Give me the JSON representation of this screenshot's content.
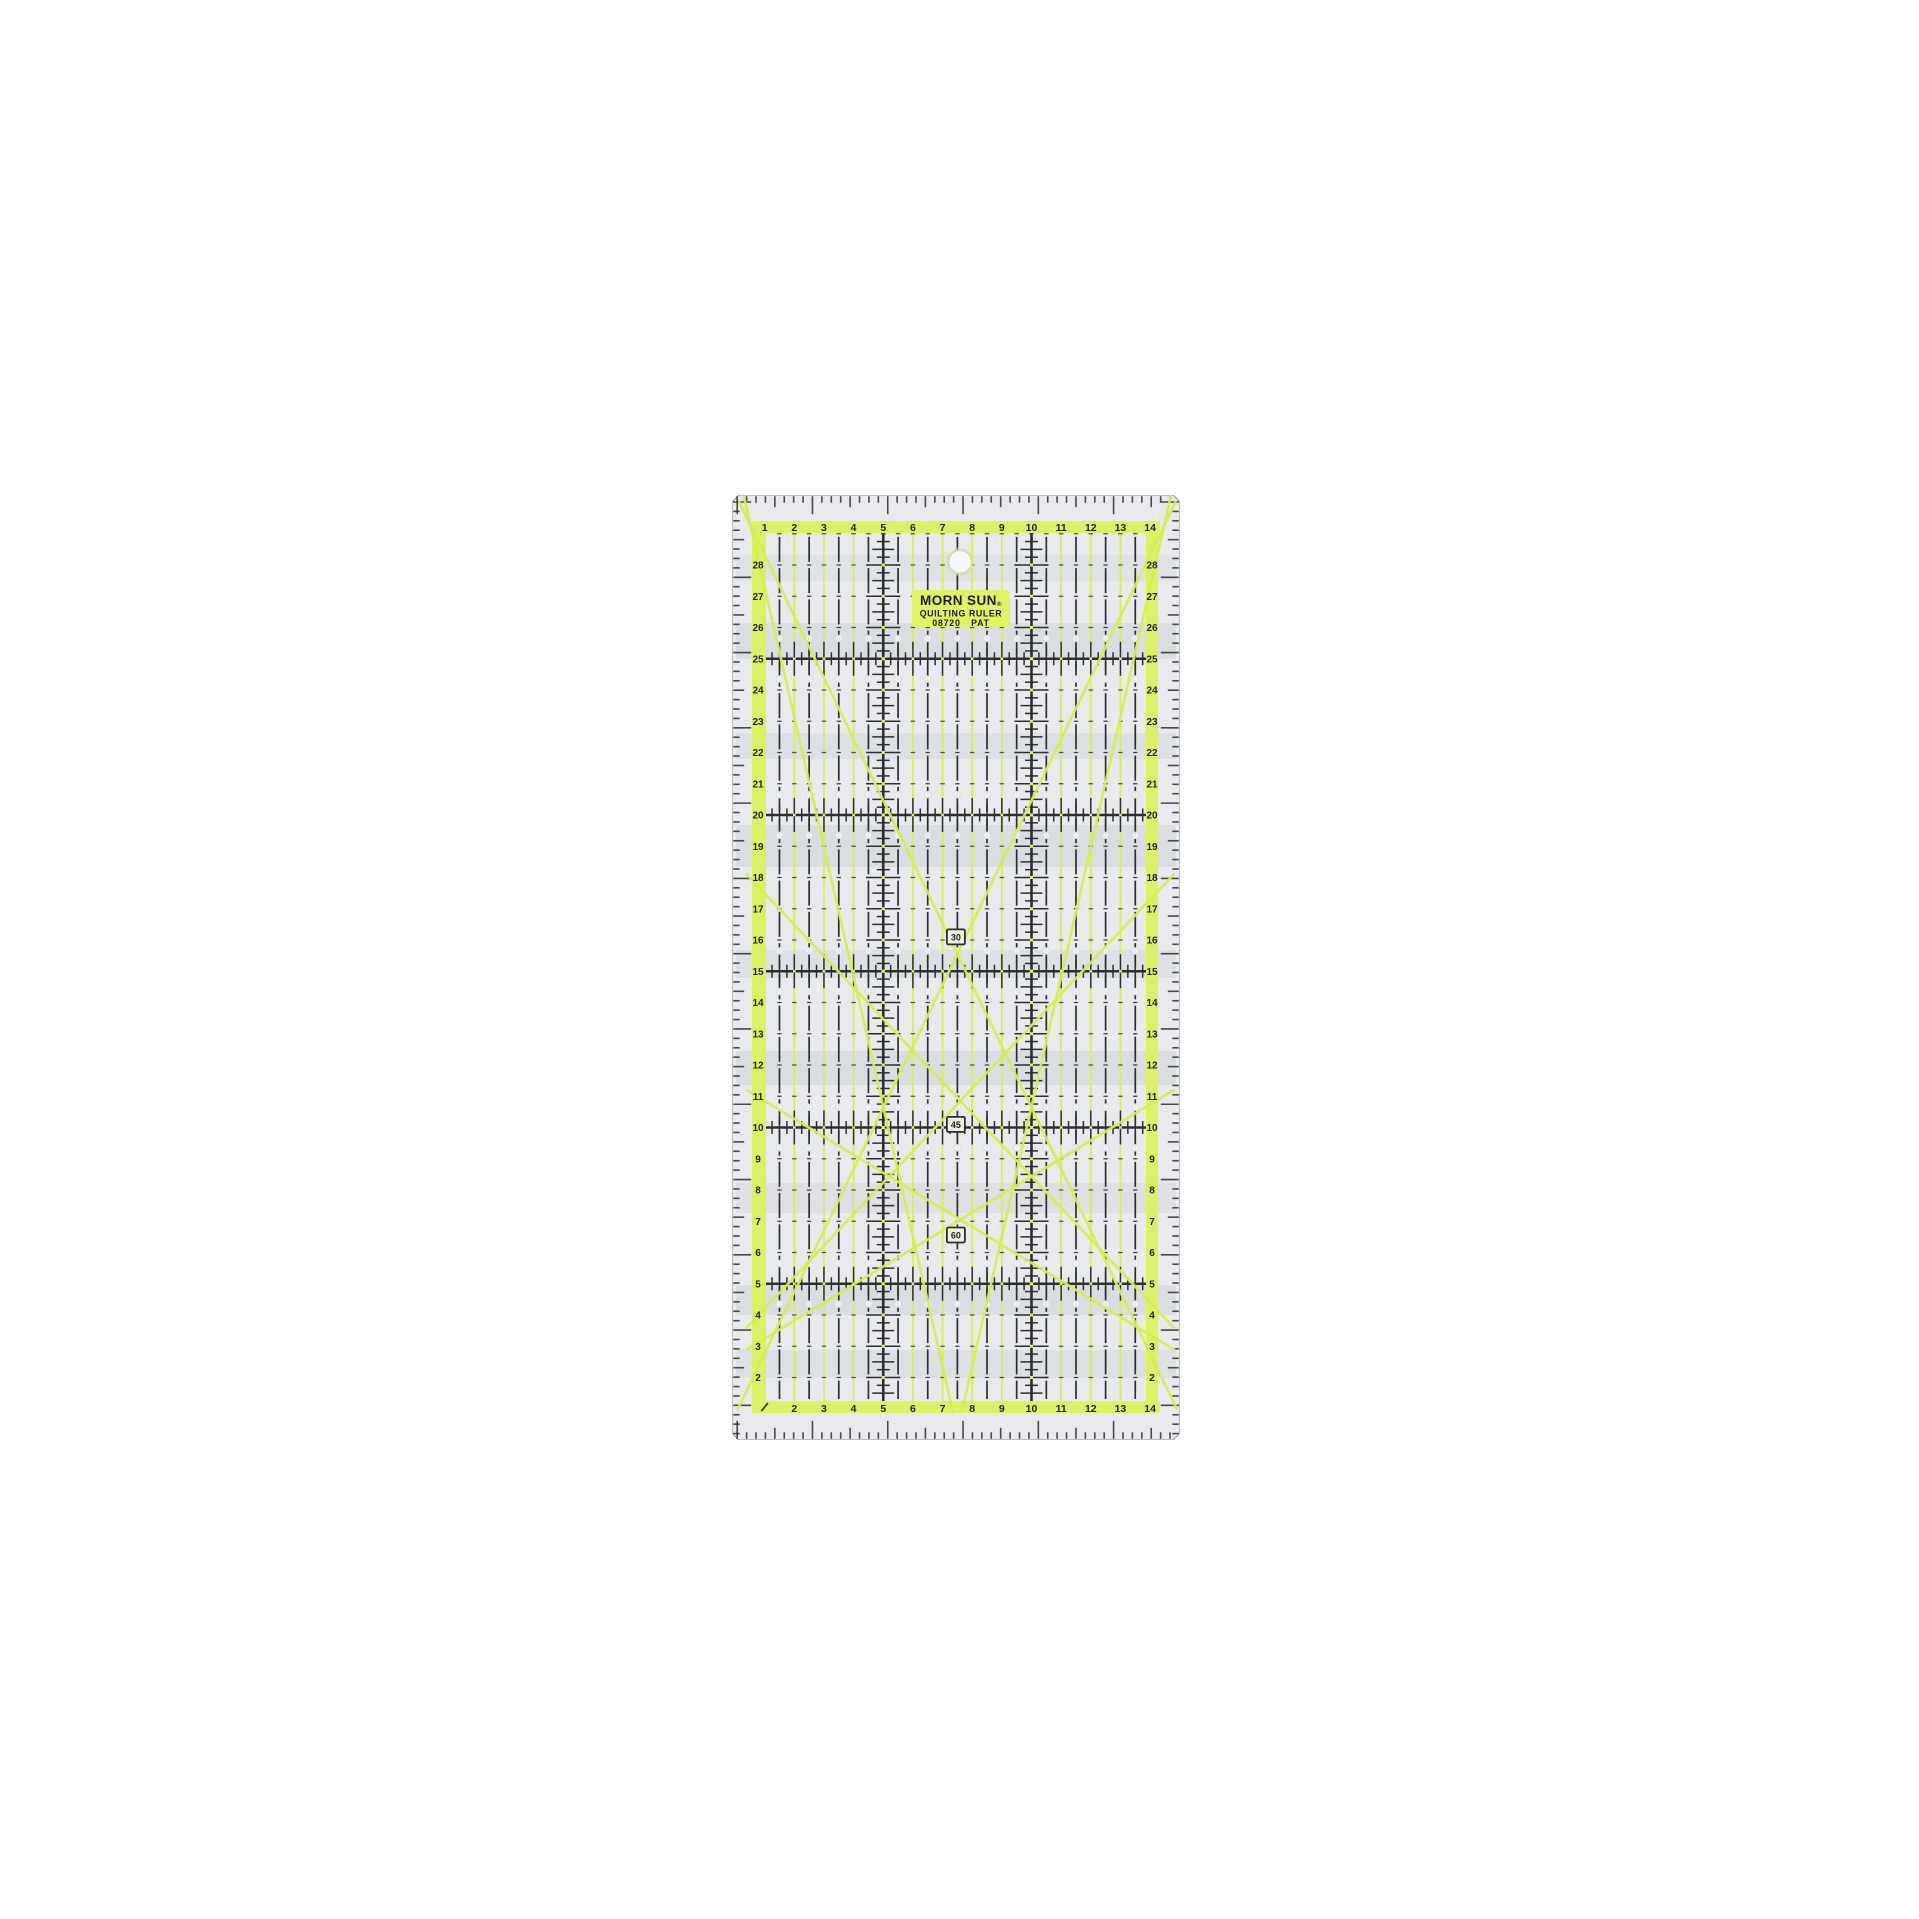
{
  "background_color": "#ffffff",
  "ruler": {
    "brand_label": {
      "line1": "MORN SUN",
      "registered": "®",
      "line2": "QUILTING RULER",
      "model": "08720",
      "pat": "PAT"
    },
    "angle_labels": [
      {
        "value": "30",
        "x_cm": 7.45,
        "y_cm": 16.1
      },
      {
        "value": "45",
        "x_cm": 7.45,
        "y_cm": 10.1
      },
      {
        "value": "60",
        "x_cm": 7.45,
        "y_cm": 6.56
      }
    ],
    "scales": {
      "top_numbers": [
        1,
        2,
        3,
        4,
        5,
        6,
        7,
        8,
        9,
        10,
        11,
        12,
        13,
        14
      ],
      "bottom_numbers": [
        2,
        3,
        4,
        5,
        6,
        7,
        8,
        9,
        10,
        11,
        12,
        13,
        14
      ],
      "left_numbers": [
        2,
        3,
        4,
        5,
        6,
        7,
        8,
        9,
        10,
        11,
        12,
        13,
        14,
        15,
        16,
        17,
        18,
        19,
        20,
        21,
        22,
        23,
        24,
        25,
        26,
        27,
        28
      ],
      "right_numbers": [
        2,
        3,
        4,
        5,
        6,
        7,
        8,
        9,
        10,
        11,
        12,
        13,
        14,
        15,
        16,
        17,
        18,
        19,
        20,
        21,
        22,
        23,
        24,
        25,
        26,
        27,
        28
      ]
    },
    "grid": {
      "width_cm": 15,
      "height_cm": 30,
      "major_lines_cm": [
        5,
        10,
        15,
        20,
        25
      ],
      "major_vertical_cm": [
        5,
        10
      ],
      "yellow_vertical_cm": [
        1,
        2,
        3,
        4,
        5,
        6,
        7,
        8,
        9,
        10,
        11,
        12,
        13
      ],
      "dashed_vertical_cm": [
        1.5,
        2.5,
        3.5,
        4.5,
        5.5,
        6.5,
        7.5,
        8.5,
        9.5,
        10.5,
        11.5,
        12.5,
        13.5
      ],
      "minor_row_cm": [
        2,
        3,
        4,
        6,
        7,
        8,
        9,
        11,
        12,
        13,
        14,
        16,
        17,
        18,
        19,
        21,
        22,
        23,
        24,
        26,
        27,
        28,
        29
      ],
      "dot_rows_cm": [
        4.35,
        5.65,
        9.35,
        10.65,
        14.35,
        15.65,
        19.35,
        20.65,
        24.35,
        25.65
      ],
      "dot_cols_cm": [
        1.5,
        2.5,
        3.5,
        4.5,
        5.5,
        6.5,
        7.5,
        8.5,
        9.5,
        10.5,
        11.5,
        12.5,
        13.5
      ]
    },
    "diagonal_lines_cm": [
      {
        "name": "line-30deg-left",
        "x1": 0.15,
        "y1": 30.0,
        "x2": 14.9,
        "y2": 1.0
      },
      {
        "name": "line-30deg-right",
        "x1": 14.85,
        "y1": 30.0,
        "x2": 0.1,
        "y2": 1.0
      },
      {
        "name": "line-steep-left",
        "x1": 0.3,
        "y1": 30.2,
        "x2": 7.35,
        "y2": 0.9
      },
      {
        "name": "line-steep-right",
        "x1": 14.7,
        "y1": 30.2,
        "x2": 7.65,
        "y2": 0.9
      },
      {
        "name": "line-45deg-up",
        "x1": 0.4,
        "y1": 3.6,
        "x2": 14.8,
        "y2": 18.1
      },
      {
        "name": "line-45deg-down",
        "x1": 0.4,
        "y1": 18.1,
        "x2": 14.8,
        "y2": 3.6
      },
      {
        "name": "line-60deg-up",
        "x1": 0.4,
        "y1": 2.9,
        "x2": 14.8,
        "y2": 11.2
      },
      {
        "name": "line-60deg-down",
        "x1": 14.8,
        "y1": 2.9,
        "x2": 0.4,
        "y2": 11.2
      }
    ],
    "hang_hole": {
      "x_cm": 7.59,
      "y_cm": 28.1
    },
    "colors": {
      "body": "#e8eaed",
      "body_edge": "#9aa0a6",
      "chartreuse_strip": "#dcf163",
      "chartreuse_line": "#d9ee58",
      "chartreuse_diagonal": "#d6ef4d",
      "print_black": "#2c2e31",
      "number_color": "#1f2124",
      "label_bg": "#dff365",
      "label_text": "#1c1c1e",
      "angle_box_bg": "#eff2e0",
      "dot_fill": "#f2f4f6",
      "dot_edge": "#d9dde1",
      "glare": "#97a0ac",
      "yellow_dot": "#e1f55c"
    }
  }
}
